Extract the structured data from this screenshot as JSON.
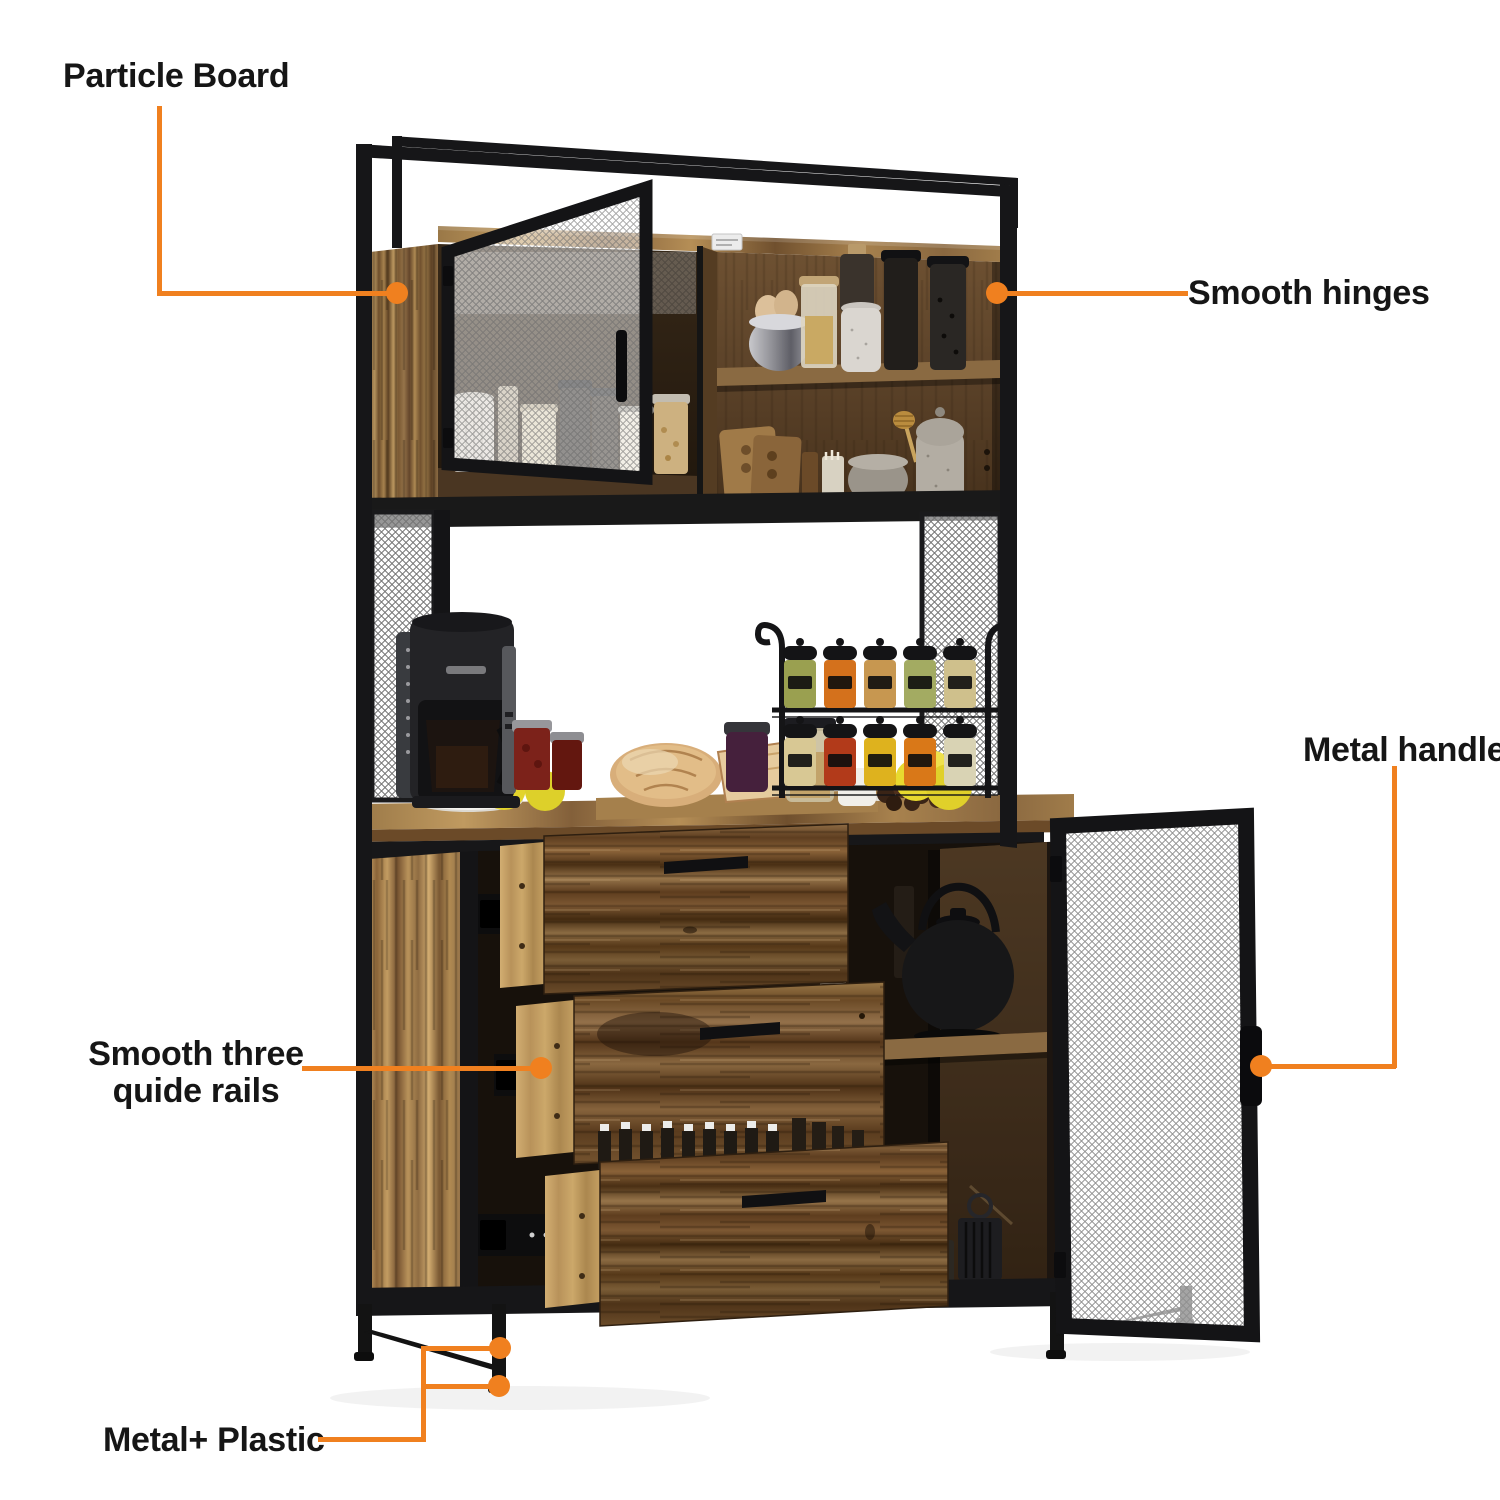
{
  "figure": {
    "alt": "Annotated product photo of an industrial kitchen hutch buffet cabinet with black metal frame, mesh doors, three pulled-out drawers, coffee maker, spice rack and pantry jars"
  },
  "callouts": {
    "particle_board": {
      "label": "Particle Board"
    },
    "smooth_hinges": {
      "label": "Smooth hinges"
    },
    "metal_handle": {
      "label": "Metal handle"
    },
    "guide_rails": {
      "line1": "Smooth three",
      "line2": "quide rails"
    },
    "metal_plastic": {
      "label": "Metal+ Plastic"
    }
  },
  "colors": {
    "accent": "#F0801F",
    "label_text": "#161616",
    "background": "#FFFFFF",
    "frame_black": "#161618",
    "wood_light": "#B28A54",
    "wood_medium": "#8A6540",
    "wood_dark": "#5C4128"
  }
}
